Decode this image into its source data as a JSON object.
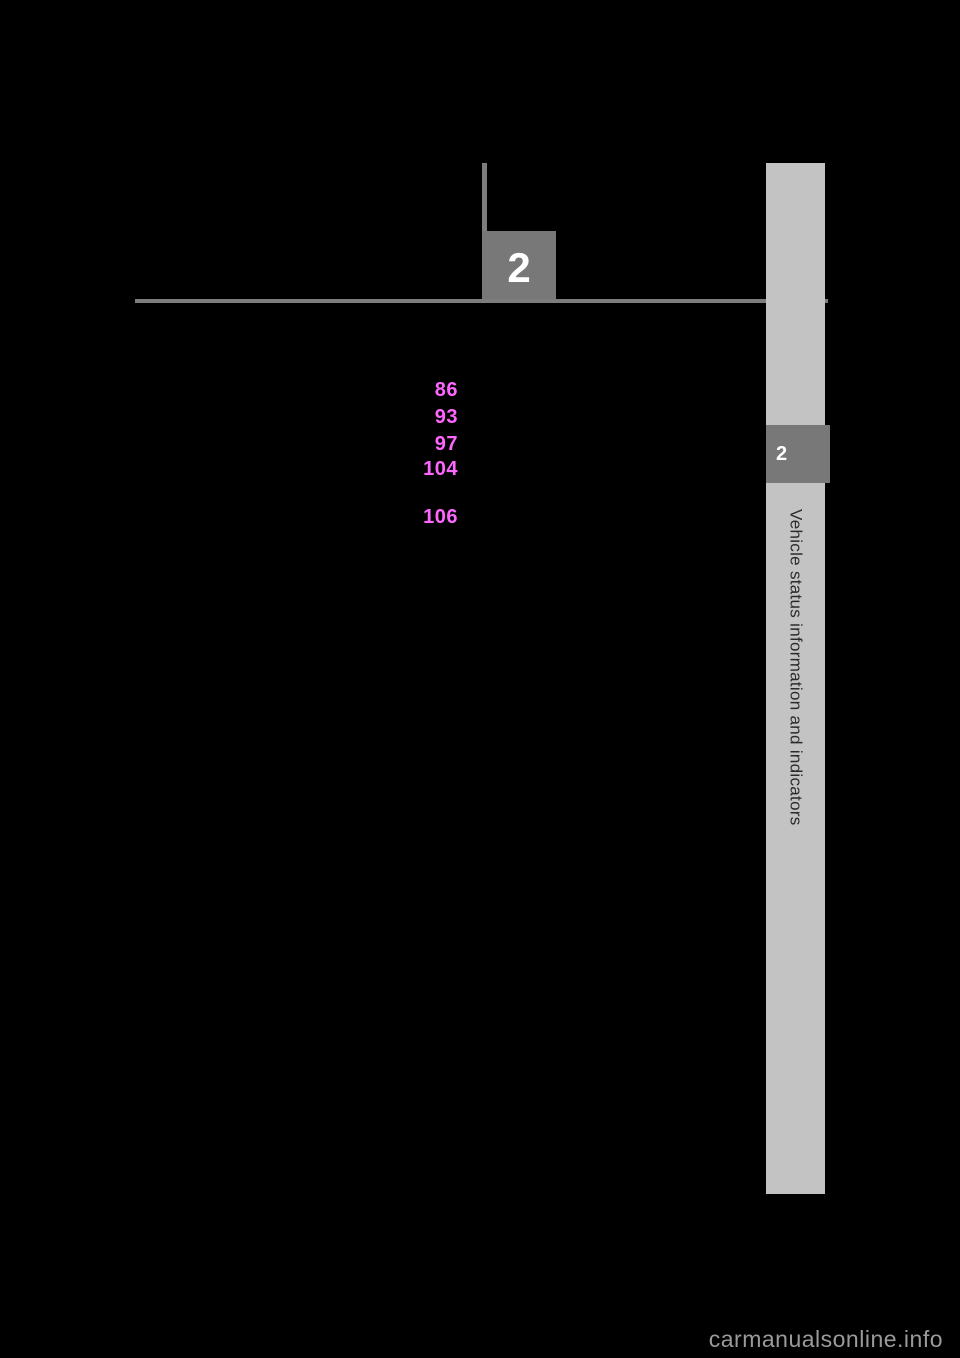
{
  "chapter": {
    "number": "2",
    "tab_number": "2",
    "sidebar_title": "Vehicle status information and indicators"
  },
  "toc": {
    "link_color": "#ff66ff",
    "page_numbers": [
      {
        "label": "86"
      },
      {
        "label": "93"
      },
      {
        "label": "97"
      },
      {
        "label": "104"
      },
      {
        "label": "106"
      }
    ]
  },
  "watermark": {
    "text": "carmanualsonline.info"
  },
  "colors": {
    "background": "#000000",
    "rule_gray": "#7d7d7d",
    "box_gray": "#787878",
    "sidebar_gray": "#c3c3c3",
    "sidebar_text": "#2b2b2b",
    "watermark_gray": "#9a9a9a"
  }
}
